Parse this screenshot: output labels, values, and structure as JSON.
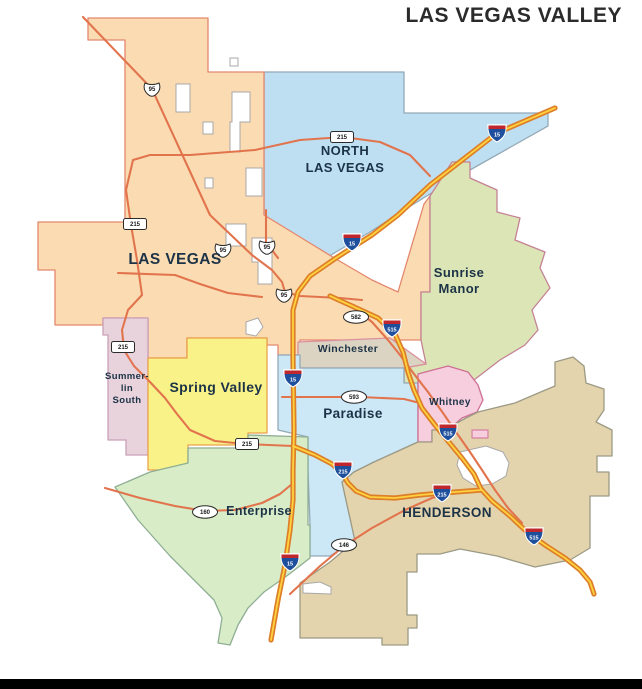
{
  "map": {
    "title": "LAS VEGAS VALLEY",
    "colors": {
      "background": "#ffffff",
      "footer_bar": "#000000",
      "label": "#1c3347",
      "road": "#e2744d",
      "interstate_casing": "#dd7e28",
      "interstate_inner": "#ffd13f",
      "shield_outline": "#2b2b2b",
      "interstate_blue": "#1e4f9c",
      "interstate_red": "#c0272d",
      "hole_fill": "#ffffff",
      "hole_stroke": "#a8a8a8"
    },
    "regions": [
      {
        "id": "north-las-vegas",
        "fill": "#bedff2",
        "stroke": "#93a9b6",
        "points": "264,72 404,72 404,113 548,113 548,126 470,170 430,194 404,210 370,232 336,252 310,268 298,280 264,230"
      },
      {
        "id": "las-vegas",
        "fill": "#fbdcb2",
        "stroke": "#e4876d",
        "points": "88,18 208,18 208,72 264,72 264,215 300,237 336,259 372,280 398,292 424,204 430,196 430,292 421,292 421,340 300,340 300,355 278,355 278,345 267,345 267,338 187,338 187,358 148,358 148,318 103,318 103,325 55,325 55,270 38,270 38,222 125,222 125,40 88,40"
      },
      {
        "id": "sunrise-manor",
        "fill": "#dbe5b6",
        "stroke": "#c58294",
        "points": "452,162 470,162 470,178 497,190 497,212 520,218 515,240 545,252 540,268 550,288 532,310 538,330 525,345 500,360 470,383 452,390 438,394 430,414 430,440 404,455 382,452 372,440 380,420 397,404 404,394 404,368 426,364 421,340 421,292 430,292 430,196"
      },
      {
        "id": "winchester",
        "fill": "#dcd4c2",
        "stroke": "#db8f9f",
        "points": "298,342 390,338 426,364 404,368 298,368"
      },
      {
        "id": "paradise",
        "fill": "#cce7f6",
        "stroke": "#93a9b6",
        "points": "278,355 300,355 300,368 404,368 404,383 418,383 418,442 396,452 374,462 354,472 342,482 355,540 330,556 310,556 310,525 308,470 308,437 278,430"
      },
      {
        "id": "whitney",
        "fill": "#f6cede",
        "stroke": "#cf6f93",
        "points": "418,374 448,366 468,372 478,385 483,400 477,412 462,418 455,424 455,430 432,430 432,442 418,442"
      },
      {
        "id": "summerlin-south",
        "fill": "#e8d3dc",
        "stroke": "#c9a0b8",
        "points": "103,318 148,318 148,455 126,455 126,440 108,440 108,335 103,335"
      },
      {
        "id": "spring-valley",
        "fill": "#f9f288",
        "stroke": "#e9a34b",
        "points": "148,358 187,358 187,338 267,338 267,433 248,433 248,445 188,445 188,470 178,470 178,496 160,496 160,470 148,470"
      },
      {
        "id": "enterprise",
        "fill": "#d7ecc7",
        "stroke": "#8fae94",
        "points": "115,487 150,472 188,463 188,448 248,448 248,435 308,437 308,525 310,525 310,558 288,575 264,592 248,608 238,625 230,645 218,643 222,618 214,600 196,582 170,556 138,520"
      },
      {
        "id": "henderson",
        "fill": "#e4d4ad",
        "stroke": "#9c9a85",
        "points": "418,442 432,442 432,430 455,430 455,424 466,418 478,412 515,403 543,391 555,386 555,362 573,357 584,366 586,383 604,389 604,410 596,422 612,430 612,456 597,456 597,472 609,472 609,496 590,496 590,548 570,560 535,567 497,556 460,549 440,554 417,554 417,572 407,572 407,615 417,615 417,628 408,628 408,645 382,645 382,638 300,638 300,583 330,562 355,541 342,482 354,472 374,462 396,452"
      }
    ],
    "white_patches": [
      {
        "points": "176,84 190,84 190,112 176,112"
      },
      {
        "points": "232,92 250,92 250,122 240,122 240,152 230,152 230,122 232,122"
      },
      {
        "points": "203,122 213,122 213,134 203,134"
      },
      {
        "points": "246,168 262,168 262,196 246,196"
      },
      {
        "points": "252,238 272,238 272,284 258,284 258,262 252,262"
      },
      {
        "points": "226,224 246,224 246,246 226,246"
      },
      {
        "points": "230,58 238,58 238,66 230,66"
      },
      {
        "points": "205,178 213,178 213,188 205,188"
      },
      {
        "points": "246,322 258,318 263,327 256,336 246,334"
      },
      {
        "points": "460,452 486,446 503,452 509,463 506,476 492,484 476,486 463,478 457,465"
      },
      {
        "points": "303,584 320,582 331,587 331,594 303,593"
      }
    ],
    "islands": [
      {
        "id": "whitney-exclave",
        "fill": "#f6cede",
        "stroke": "#cf6f93",
        "points": "472,430 488,430 488,438 472,438"
      }
    ],
    "roads": [
      {
        "id": "us95-northwest",
        "points": "83,17 152,89 210,215 252,255 272,270 282,282 285,292 300,296 340,298 362,300"
      },
      {
        "id": "us95-north-spur",
        "points": "266,210 266,242 278,258"
      },
      {
        "id": "charleston",
        "points": "118,273 175,275 200,284 228,293 262,297"
      },
      {
        "id": "cc-215-beltway",
        "points": "430,176 410,155 380,142 343,137 300,140 255,150 190,155 150,155 133,160 126,190 131,225 137,260 142,295 128,310 122,330 124,350 134,366 150,382 165,398 177,414 190,430 215,441 245,444 293,446"
      },
      {
        "id": "boulder-hwy-582",
        "points": "352,306 372,322 388,340 400,355 414,374 428,392 443,413 456,432 470,452 482,470 495,490 508,508 522,523"
      },
      {
        "id": "tropicana-593",
        "points": "282,397 360,397 404,399 420,403"
      },
      {
        "id": "blue-diamond-160",
        "points": "105,488 140,498 175,506 205,511 235,510 262,503 280,494 292,484"
      },
      {
        "id": "st-rose-146",
        "points": "290,594 320,566 344,546 372,528 405,510 432,498 447,494"
      }
    ],
    "interstates": [
      {
        "id": "i-15",
        "points": "555,108 497,133 430,185 398,215 372,235 336,258 310,276 298,292 293,310 293,360 294,430 293,470 293,500 290,530 285,565 278,600 271,640"
      },
      {
        "id": "i-215",
        "points": "293,446 315,455 332,464 342,473 348,483 356,491 370,497 395,498 420,495 442,493 482,490"
      },
      {
        "id": "i-515",
        "points": "330,296 352,306 378,318 395,334 403,352 408,372 414,390 422,408 435,425 448,441 462,458 474,474 481,489 492,501 510,516 527,532 545,545 565,558 580,570 590,582 594,594"
      }
    ],
    "shields": [
      {
        "kind": "us",
        "text": "95",
        "x": 152,
        "y": 89
      },
      {
        "kind": "us",
        "text": "95",
        "x": 223,
        "y": 250
      },
      {
        "kind": "us",
        "text": "95",
        "x": 267,
        "y": 247
      },
      {
        "kind": "us",
        "text": "95",
        "x": 284,
        "y": 295
      },
      {
        "kind": "box",
        "text": "215",
        "x": 342,
        "y": 137
      },
      {
        "kind": "box",
        "text": "215",
        "x": 135,
        "y": 224
      },
      {
        "kind": "box",
        "text": "215",
        "x": 123,
        "y": 347
      },
      {
        "kind": "box",
        "text": "215",
        "x": 247,
        "y": 444
      },
      {
        "kind": "oval",
        "text": "582",
        "x": 356,
        "y": 317
      },
      {
        "kind": "oval",
        "text": "593",
        "x": 354,
        "y": 397
      },
      {
        "kind": "oval",
        "text": "160",
        "x": 205,
        "y": 512
      },
      {
        "kind": "oval",
        "text": "146",
        "x": 344,
        "y": 545
      },
      {
        "kind": "interstate",
        "text": "15",
        "x": 497,
        "y": 133
      },
      {
        "kind": "interstate",
        "text": "15",
        "x": 352,
        "y": 242
      },
      {
        "kind": "interstate",
        "text": "15",
        "x": 293,
        "y": 378
      },
      {
        "kind": "interstate",
        "text": "15",
        "x": 290,
        "y": 562
      },
      {
        "kind": "interstate",
        "text": "515",
        "x": 392,
        "y": 328
      },
      {
        "kind": "interstate",
        "text": "515",
        "x": 448,
        "y": 432
      },
      {
        "kind": "interstate",
        "text": "515",
        "x": 534,
        "y": 536
      },
      {
        "kind": "interstate",
        "text": "215",
        "x": 343,
        "y": 470
      },
      {
        "kind": "interstate",
        "text": "215",
        "x": 442,
        "y": 493
      }
    ],
    "labels": [
      {
        "id": "north-las-vegas",
        "lines": [
          "NORTH",
          "LAS VEGAS"
        ],
        "x": 345,
        "y": 155,
        "lh": 17,
        "size": 13
      },
      {
        "id": "las-vegas",
        "lines": [
          "LAS VEGAS"
        ],
        "x": 175,
        "y": 264,
        "lh": 17,
        "size": 15.5
      },
      {
        "id": "sunrise-manor",
        "lines": [
          "Sunrise",
          "Manor"
        ],
        "x": 459,
        "y": 277,
        "lh": 16,
        "size": 13
      },
      {
        "id": "winchester",
        "lines": [
          "Winchester"
        ],
        "x": 348,
        "y": 352,
        "lh": 12,
        "size": 10.5
      },
      {
        "id": "summerlin-south",
        "lines": [
          "Summer-",
          "lin",
          "South"
        ],
        "x": 127,
        "y": 379,
        "lh": 12,
        "size": 9.5
      },
      {
        "id": "spring-valley",
        "lines": [
          "Spring Valley"
        ],
        "x": 216,
        "y": 392,
        "lh": 16,
        "size": 14
      },
      {
        "id": "paradise",
        "lines": [
          "Paradise"
        ],
        "x": 353,
        "y": 418,
        "lh": 15,
        "size": 13.5
      },
      {
        "id": "whitney",
        "lines": [
          "Whitney"
        ],
        "x": 450,
        "y": 405,
        "lh": 12,
        "size": 10
      },
      {
        "id": "enterprise",
        "lines": [
          "Enterprise"
        ],
        "x": 259,
        "y": 515,
        "lh": 14,
        "size": 12.5
      },
      {
        "id": "henderson",
        "lines": [
          "HENDERSON"
        ],
        "x": 447,
        "y": 517,
        "lh": 15,
        "size": 13.5
      }
    ]
  }
}
